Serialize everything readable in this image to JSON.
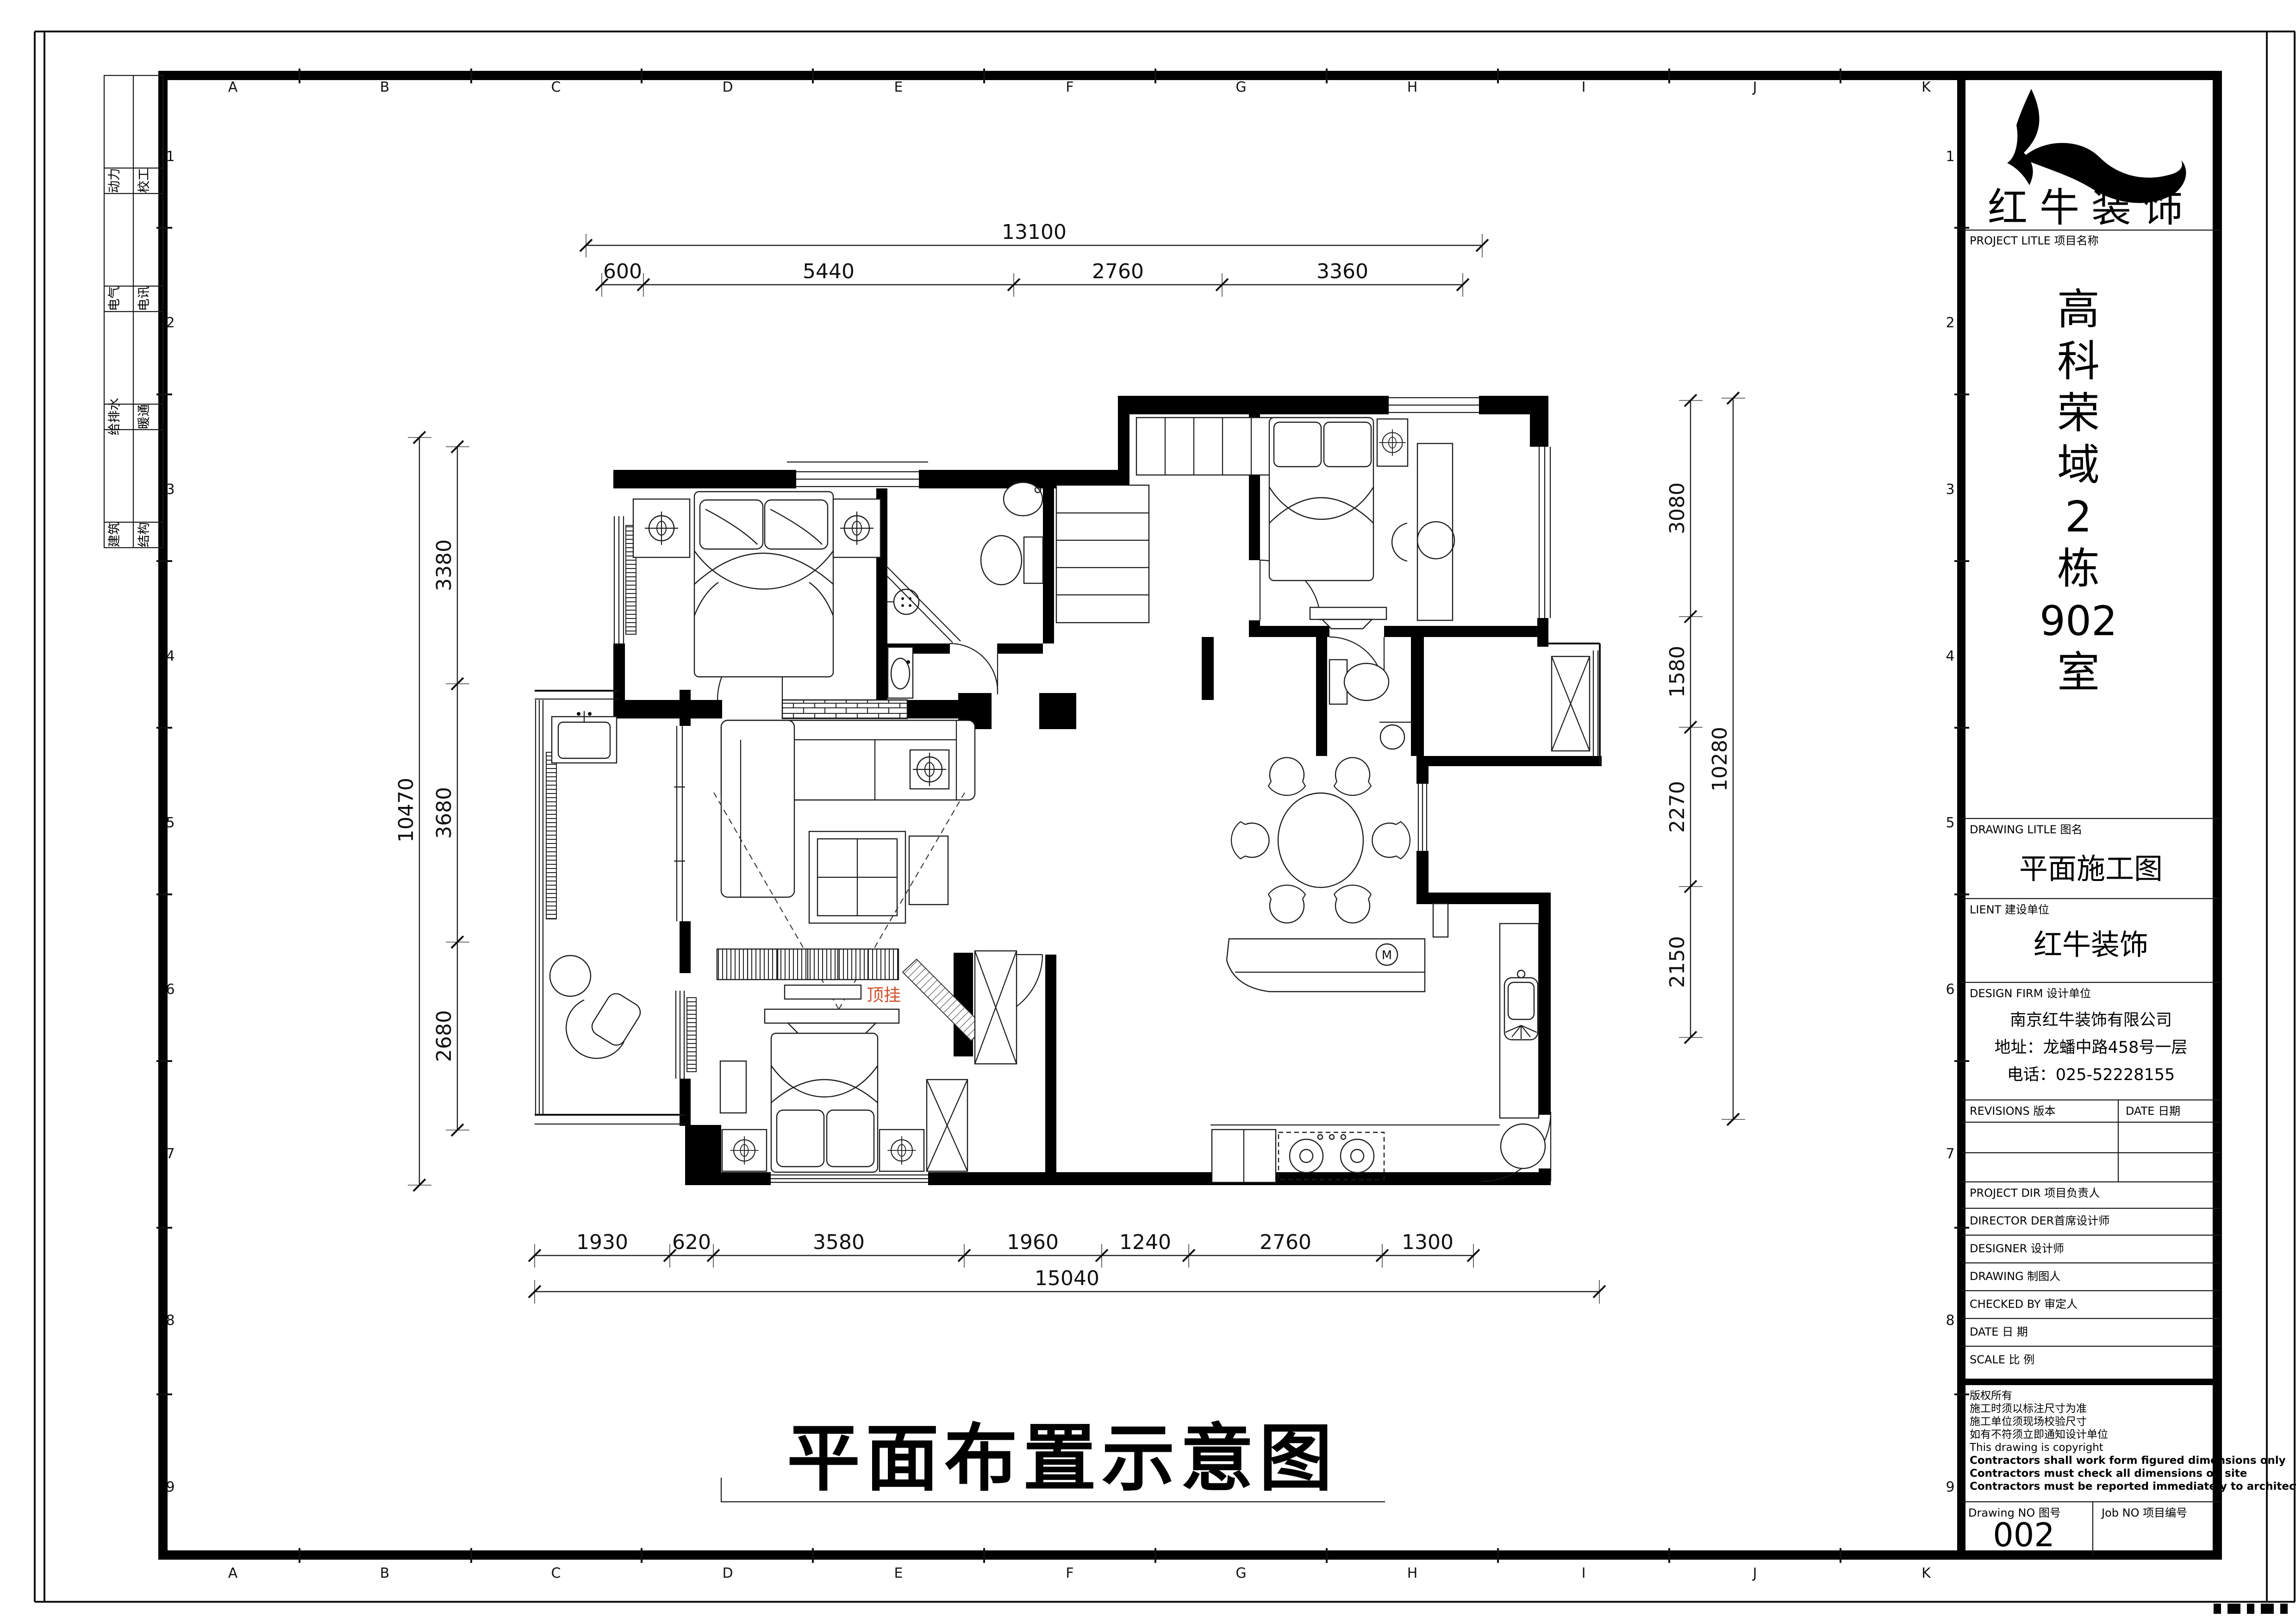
{
  "sheet": {
    "grid_letters": [
      "A",
      "B",
      "C",
      "D",
      "E",
      "F",
      "G",
      "H",
      "I",
      "J",
      "K"
    ],
    "grid_numbers": [
      "1",
      "2",
      "3",
      "4",
      "5",
      "6",
      "7",
      "8",
      "9"
    ]
  },
  "disciplines": {
    "rows": [
      {
        "left": "动力",
        "right": "校工"
      },
      {
        "left": "电气",
        "right": "电讯"
      },
      {
        "left": "给排水",
        "right": "暖通"
      },
      {
        "left": "建筑",
        "right": "结构"
      }
    ]
  },
  "caption": "平面布置示意图",
  "plan": {
    "ceiling_label": "顶挂",
    "microwave_label": "M"
  },
  "dims": {
    "top": {
      "total": "13100",
      "segments": [
        "600",
        "5440",
        "2760",
        "3360"
      ]
    },
    "bottom": {
      "total": "15040",
      "segments": [
        "1930",
        "620",
        "3580",
        "1960",
        "1240",
        "2760",
        "1300"
      ]
    },
    "left": {
      "total": "10470",
      "segments": [
        "3380",
        "3680",
        "2680"
      ]
    },
    "right": {
      "total": "10280",
      "segments": [
        "3080",
        "1580",
        "2270",
        "2150"
      ]
    }
  },
  "title_block": {
    "logo_text": "红牛装饰",
    "project_label": "PROJECT LITLE 项目名称",
    "project_name_lines": [
      "高",
      "科",
      "荣",
      "域",
      "2",
      "栋",
      "902",
      "室"
    ],
    "drawing_title_label": "DRAWING LITLE 图名",
    "drawing_title": "平面施工图",
    "client_label": "LIENT 建设单位",
    "client": "红牛装饰",
    "design_firm_label": "DESIGN FIRM 设计单位",
    "firm_lines": [
      "南京红牛装饰有限公司",
      "地址：龙蟠中路458号一层",
      "电话：025-52228155"
    ],
    "revisions_label": "REVISIONS 版本",
    "date_label": "DATE 日期",
    "project_dir_label": "PROJECT DIR 项目负责人",
    "director_label": "DIRECTOR DER首席设计师",
    "designer_label": "DESIGNER 设计师",
    "drawing_label": "DRAWING 制图人",
    "checked_label": "CHECKED BY 审定人",
    "date2_label": "DATE 日 期",
    "scale_label": "SCALE 比 例",
    "copyright_lines": [
      "版权所有",
      "施工时须以标注尺寸为准",
      "施工单位须现场校验尺寸",
      "如有不符须立即通知设计单位",
      "This drawing is copyright",
      "Contractors shall work form figured dimensions only",
      "Contractors must check all dimensions on site",
      "Contractors must be reported immediately to architects"
    ],
    "drawing_no_label": "Drawing NO 图号",
    "drawing_no": "002",
    "job_no_label": "Job NO 项目编号"
  }
}
